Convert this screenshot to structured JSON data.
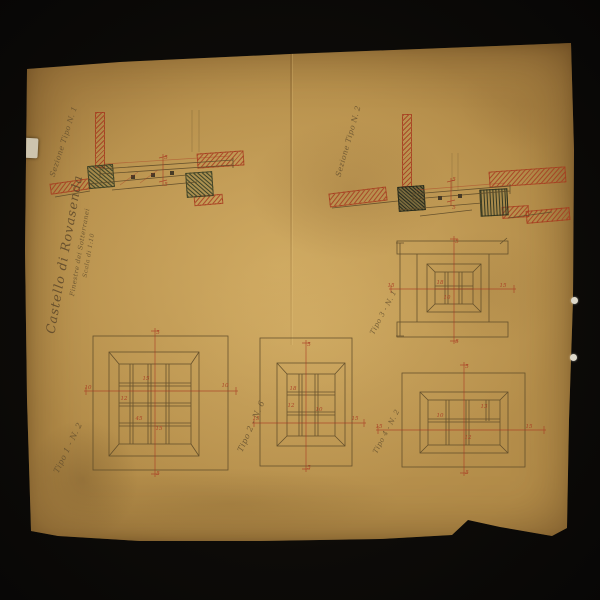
{
  "palette": {
    "background": "#0b0907",
    "paper": "#bf9c58",
    "ink": "#5d4a28",
    "red_ink": "#a83620",
    "green_ink": "#3f4a2a"
  },
  "title_block": {
    "project": "Castello di Rovasenda",
    "subject": "Finestre dei Sotterranei",
    "scale": "Scala di 1:10"
  },
  "sections": {
    "left_label": "Sezione Tipo N. 1",
    "right_label": "Sezione Tipo N. 2"
  },
  "plans": {
    "plan1_label": "Tipo 1 - N. 2",
    "plan2_label": "Tipo 2 - N. 6",
    "plan3_label": "Tipo 3 - N. 1",
    "plan4_label": "Tipo 4 - N. 2"
  },
  "dimension_marks": {
    "s1": "5",
    "s2": "5",
    "s3": "5",
    "s4": "5",
    "a1": "5",
    "a2": "10",
    "a3": "10",
    "a4": "15",
    "a5": "12",
    "a6": "45",
    "a7": "15",
    "a8": "5",
    "b1": "5",
    "b2": "15",
    "b3": "15",
    "b4": "18",
    "b5": "12",
    "b6": "10",
    "b7": "5",
    "c1": "5",
    "c2": "15",
    "c3": "15",
    "c4": "18",
    "c5": "10",
    "c6": "5",
    "d1": "5",
    "d2": "15",
    "d3": "15",
    "d4": "13",
    "d5": "10",
    "d6": "12",
    "d7": "5"
  }
}
